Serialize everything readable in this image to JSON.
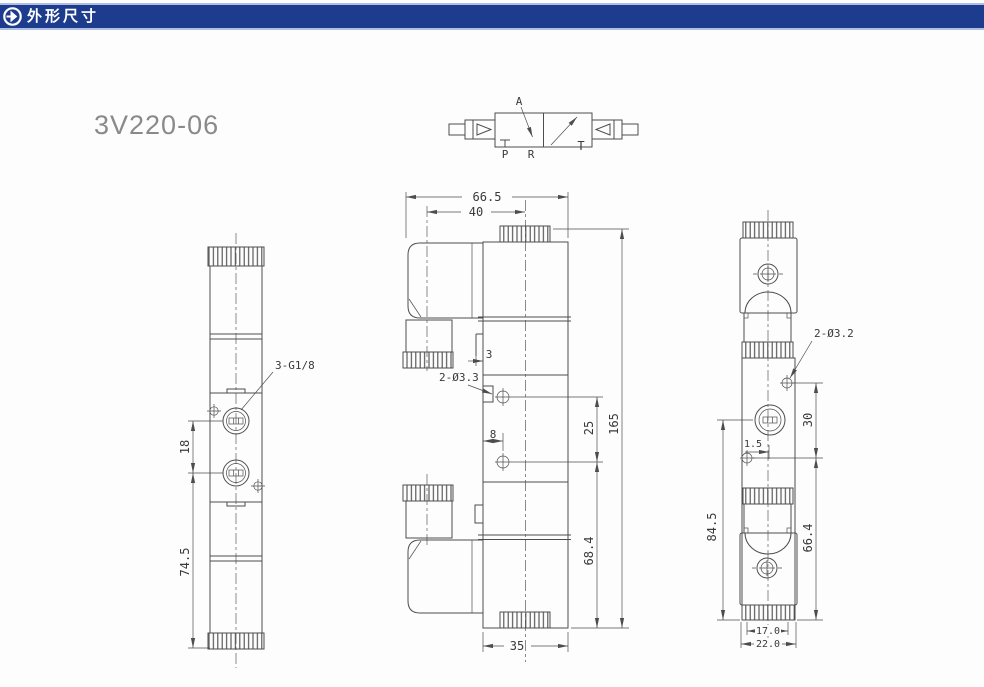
{
  "header": {
    "title": "外形尺寸",
    "icon": "arrow-right-circle-icon",
    "bar_color": "#1d3c8e",
    "text_color": "#ffffff"
  },
  "model": {
    "name": "3V220-06"
  },
  "schematic": {
    "port_labels": {
      "a": "A",
      "p": "P",
      "r": "R",
      "t": "T"
    }
  },
  "views": {
    "left": {
      "name": "side-view",
      "port_label": "3-G1/8",
      "dims": {
        "port_spacing": "18",
        "port_to_base": "74.5"
      }
    },
    "middle": {
      "name": "front-view",
      "mount_hole_label": "2-Ø3.3",
      "dims": {
        "overall_width": "66.5",
        "coil_center_offset": "40",
        "bracket_thickness": "3",
        "hole_edge_offset": "8",
        "mount_hole_spacing": "25",
        "overall_height": "165",
        "base_to_hole": "68.4",
        "body_width": "35"
      }
    },
    "right": {
      "name": "end-view",
      "mount_hole_label": "2-Ø3.2",
      "dims": {
        "port_center_offset": "1.5",
        "hole_spacing": "30",
        "overall_height": "84.5",
        "lower_height": "66.4",
        "body_width": "17.0",
        "overall_width": "22.0"
      }
    }
  },
  "colors": {
    "header_bar": "#1d3c8e",
    "line": "#4d4d4d",
    "dimension_text": "#3a3a3a",
    "model_text": "#8a8a8a"
  }
}
